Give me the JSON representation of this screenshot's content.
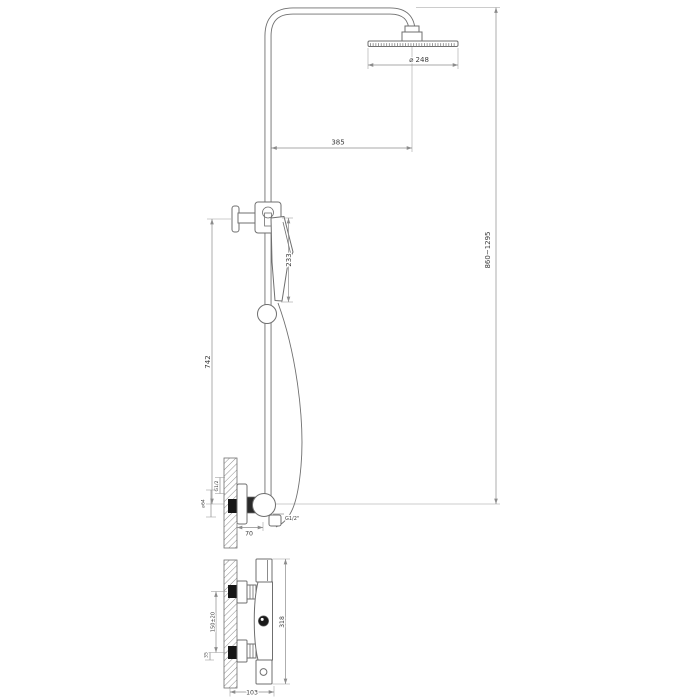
{
  "meta": {
    "description": "Technical line drawing of a thermostatic shower column (front elevation with dimensions, plus separate mixer front view)",
    "background": "#ffffff",
    "line_color": "#6f6f6f",
    "dim_color": "#8c8c8c",
    "text_color": "#3b3b3b",
    "inlet_fill": "#161616"
  },
  "views": {
    "front": {
      "name": "shower-column-front-elevation",
      "dims": {
        "head_diameter": "⌀ 248",
        "head_offset": "385",
        "hand_shower_length": "233",
        "riser_height": "742",
        "overall_height": "860~1295",
        "wall_thread": "G1/2",
        "escutcheon_diameter": "⌀64",
        "outlet_thread": "G1/2\"",
        "outlet_depth": "70"
      }
    },
    "mixer": {
      "name": "mixer-valve-front-view",
      "dims": {
        "inlet_spacing": "150±20",
        "inlet_offset": "35",
        "body_span": "318",
        "wall_depth": "103"
      }
    }
  }
}
